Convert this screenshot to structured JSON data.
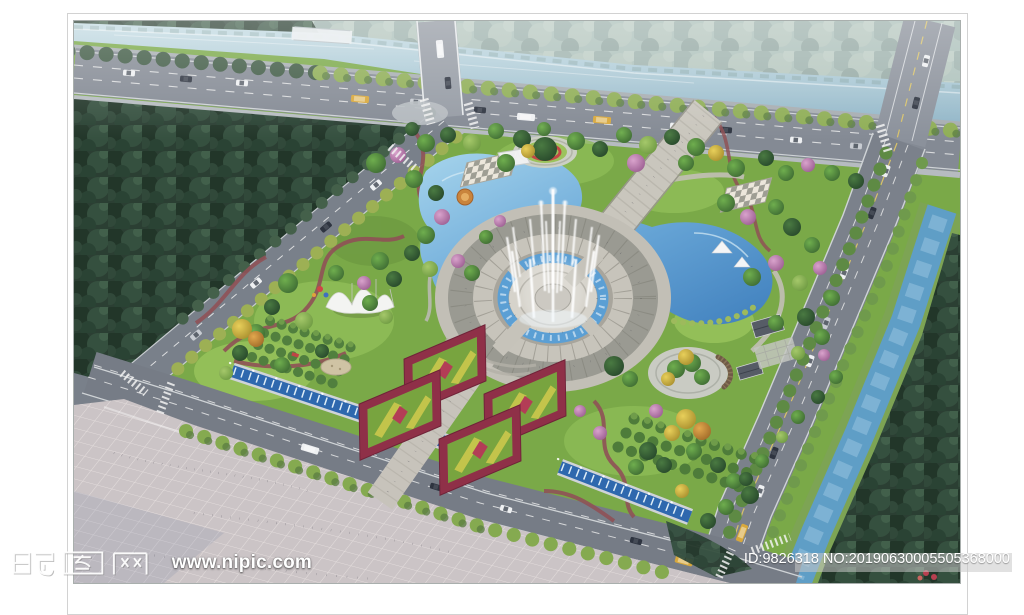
{
  "watermarks": {
    "site_name": "昵图网",
    "site_url": "www.nipic.com",
    "image_id": "ID:9826318 NO:20190630005505368000"
  },
  "palette": {
    "page_background": "#ffffff",
    "frame_line": "#d2d2d2",
    "river_water": "#a9c8d6",
    "lake_water": "#5d9bcf",
    "channel_water": "#2e68ae",
    "road_asphalt": "#7d838d",
    "plaza_paving": "#cbc4c6",
    "ring_paving_light": "#c7c4bb",
    "ring_paving_dark": "#9a9a92",
    "lawn_green": "#7aa948",
    "forest_dark": "#2b3f33",
    "tree_yellow": "#d8bc50",
    "blossom_pink": "#c687b8",
    "parterre_red": "#8f3048",
    "fountain_white": "#ffffff",
    "watermark_bar": "#c9c9c9"
  }
}
